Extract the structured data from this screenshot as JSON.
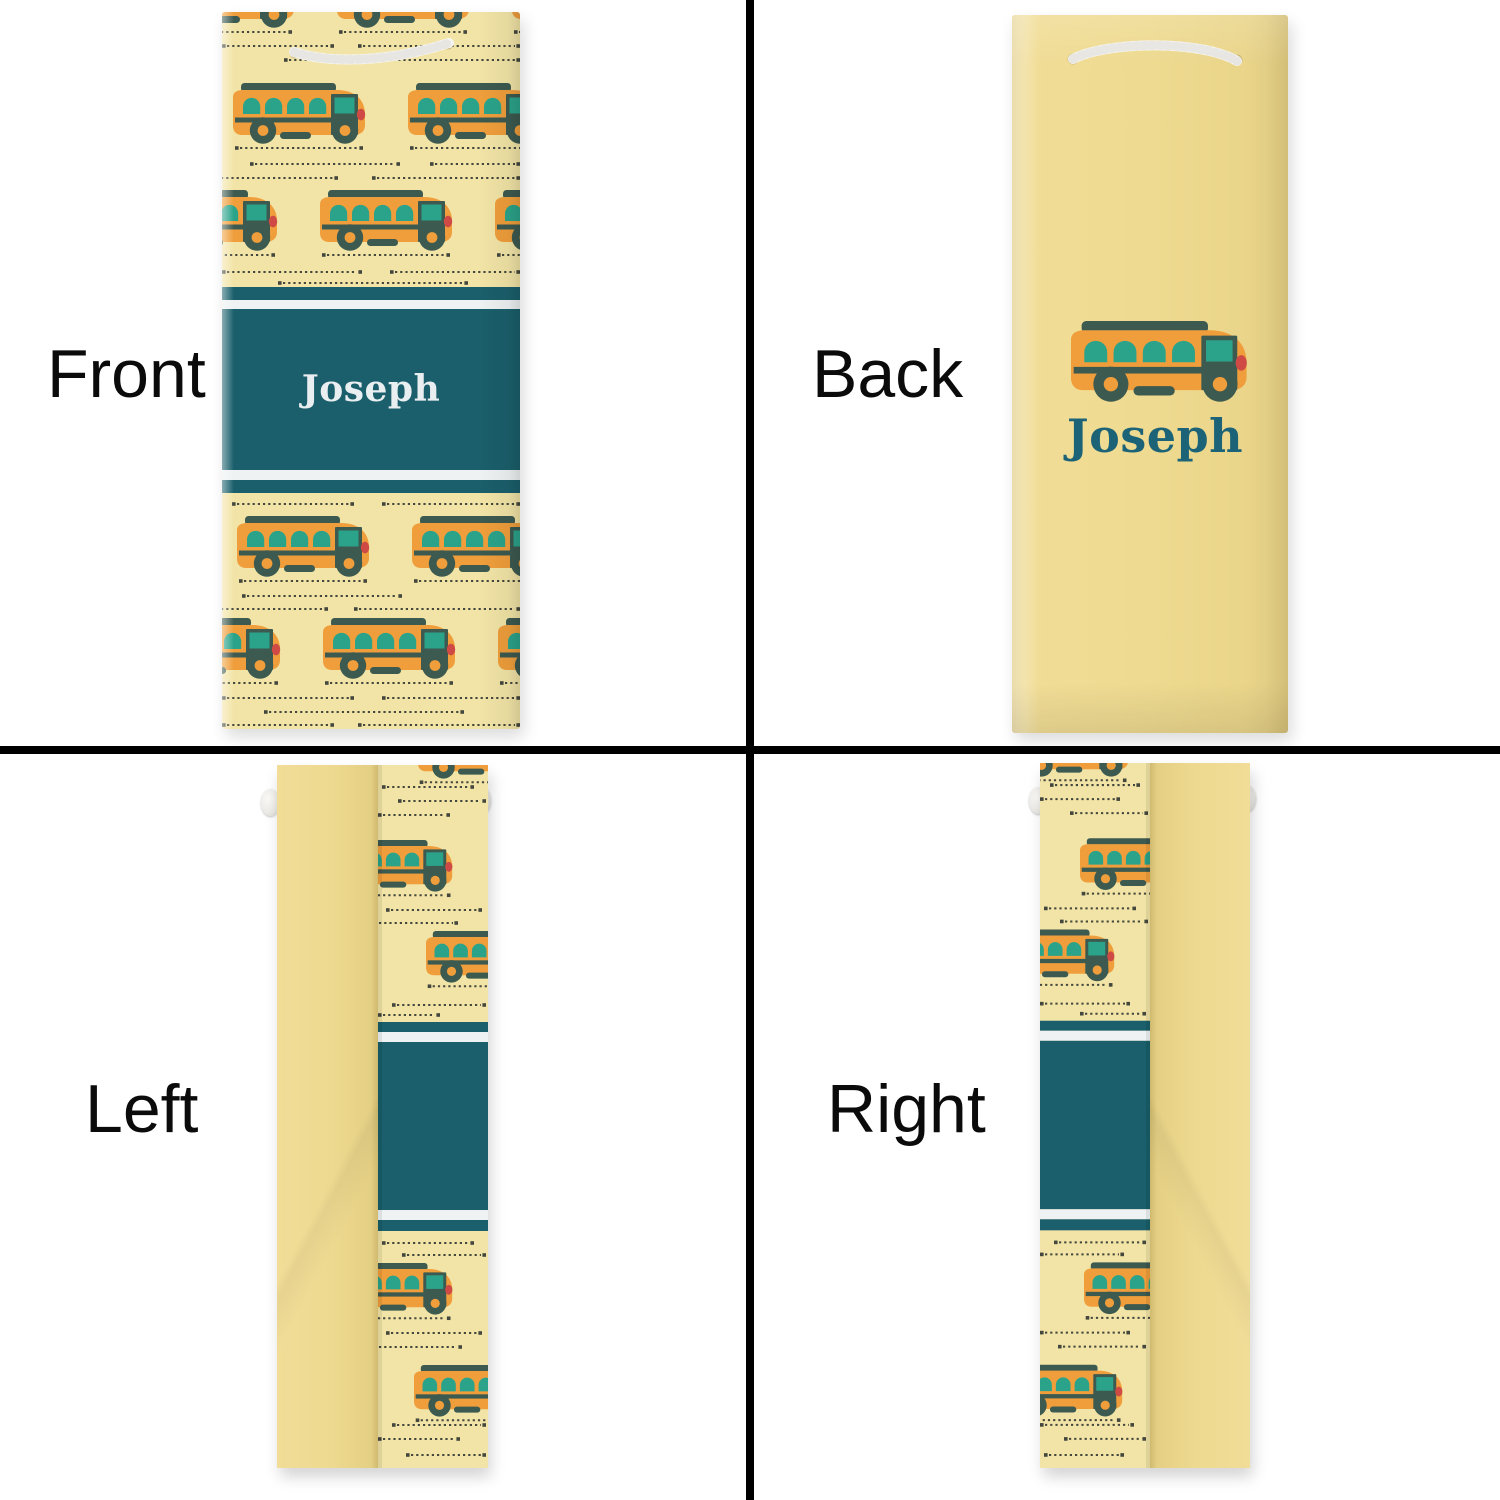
{
  "views": {
    "front": {
      "label": "Front"
    },
    "back": {
      "label": "Back"
    },
    "left": {
      "label": "Left"
    },
    "right": {
      "label": "Right"
    }
  },
  "personalization": {
    "name": "Joseph"
  },
  "icons": {
    "bus": "school-bus-icon",
    "handle": "rope-handle-icon"
  },
  "colors": {
    "pattern_background": "#f2e4a6",
    "plain_bag_yellow": "#eeda90",
    "bus_orange": "#ef9e3b",
    "bus_window_teal": "#2ba38a",
    "bus_dark": "#3d5a50",
    "bus_tail_light_red": "#cf4a45",
    "band_teal": "#1a5f6b",
    "band_stripe_white": "#eef2f2",
    "name_front_white": "#e9eef0",
    "name_back_teal": "#1c6377",
    "dotted_line": "#44473d",
    "divider_black": "#000000",
    "rope_white": "#f6f5f1"
  }
}
